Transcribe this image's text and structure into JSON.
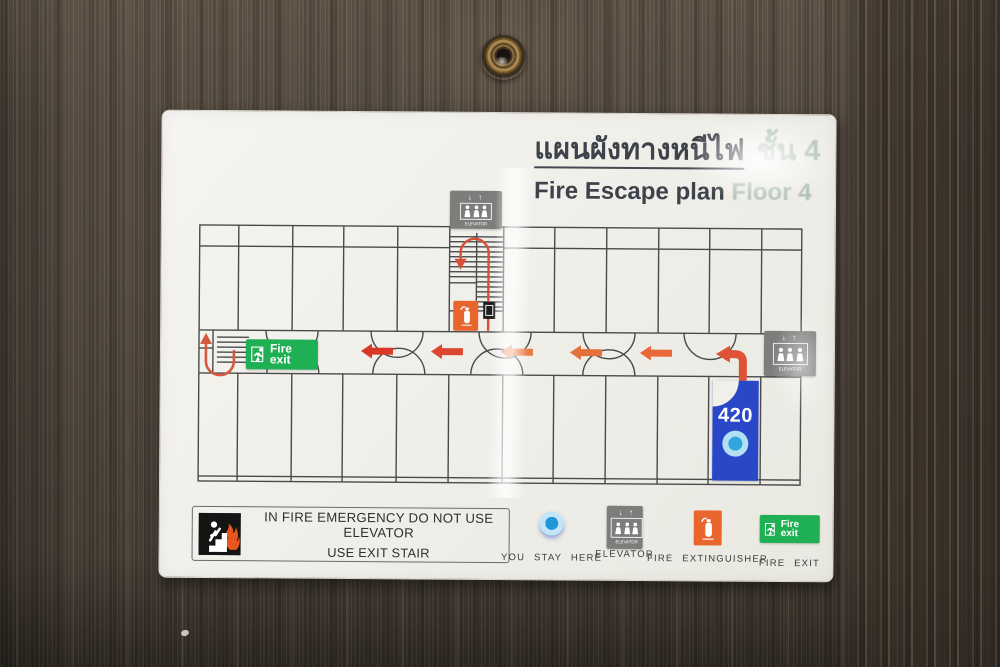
{
  "title": {
    "thai_main": "แผนผังทางหนีไฟ",
    "thai_floor": "ชั้น 4",
    "en_main": "Fire Escape plan",
    "en_floor": "Floor 4"
  },
  "plan": {
    "room_number": "420",
    "exit_sign": {
      "word1": "Fire",
      "word2": "exit"
    },
    "elevator": {
      "arrows": "↓ ↑",
      "label": "ELEVATOR"
    }
  },
  "legend": {
    "warning_line1": "IN FIRE EMERGENCY DO NOT USE ELEVATOR",
    "warning_line2": "USE EXIT STAIR",
    "you_stay_here": "YOU STAY HERE",
    "elevator": "ELEVATOR",
    "fire_extinguisher": "FIRE EXTINGUISHER",
    "fire_exit": "FIRE EXIT"
  },
  "colors": {
    "exit_green": "#1fb053",
    "route_red": "#da3826",
    "route_orange": "#e8743f",
    "room_blue": "#2948c8",
    "marker_blue": "#2fa7dd",
    "extinguisher_orange": "#e8662d",
    "elevator_gray": "#7e7d7b",
    "sign_background": "#f0efea",
    "door_brown": "#4b4239"
  }
}
